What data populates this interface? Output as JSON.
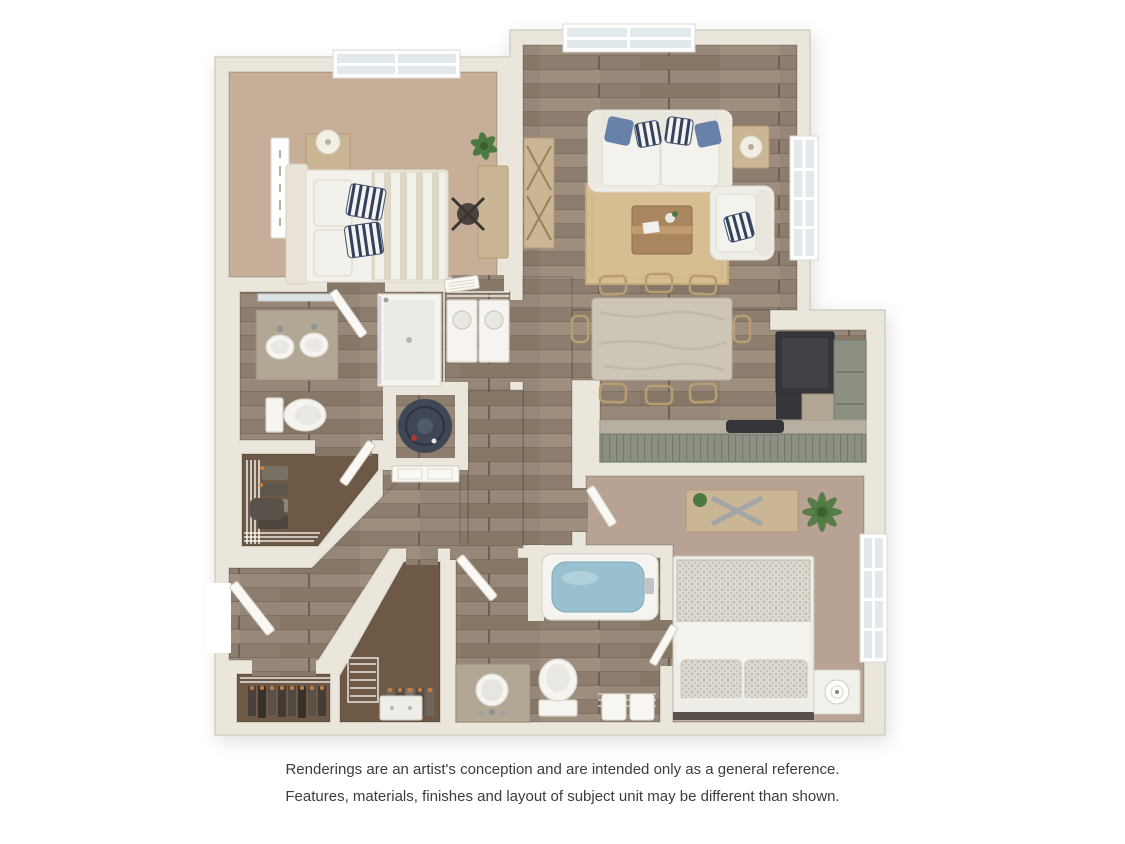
{
  "page": {
    "background": "#ffffff"
  },
  "floorplan": {
    "type": "3d-rendered-apartment-floor-plan",
    "rooms": [
      "bedroom-1",
      "living-room",
      "dining-area",
      "kitchen",
      "bedroom-2",
      "bathroom-1",
      "bathroom-2",
      "laundry-closet",
      "water-heater-closet",
      "walk-in-closet",
      "coat-closet",
      "secondary-closet",
      "entry",
      "hallway"
    ],
    "furniture": [
      "bed",
      "nightstand",
      "table-lamp",
      "wall-art",
      "desk",
      "desk-chair",
      "potted-plant",
      "sofa",
      "accent-pillows",
      "armchair",
      "side-table",
      "coffee-table",
      "area-rug",
      "dining-table",
      "dining-chairs",
      "refrigerator",
      "range",
      "bar-counter",
      "kitchen-cabinets",
      "double-vanity",
      "shower",
      "toilet",
      "washer",
      "dryer",
      "water-heater",
      "bathtub",
      "single-vanity",
      "linen-shelf",
      "towels",
      "dresser",
      "palm-plant",
      "wire-shelving",
      "hanging-clothes"
    ]
  },
  "disclaimer": {
    "line1": "Renderings are an artist's conception and are intended only as a general reference.",
    "line2": "Features, materials, finishes and layout of subject unit may be different than shown."
  },
  "palette": {
    "page_bg": "#ffffff",
    "wall": "#eae6dc",
    "wall_edge": "#d5cfc0",
    "wood_a": "#8c7d6f",
    "wood_b": "#968779",
    "wood_seam": "#6e6153",
    "carpet_bedroom1": "#c6ae99",
    "carpet_bedroom2": "#b7a293",
    "carpet_closet": "#6d5946",
    "rug": "#d7bd92",
    "marble": "#cdc5b6",
    "counter": "#b2a695",
    "cabinet_green": "#8b9083",
    "appliance_dark": "#35353a",
    "fabric_white": "#f3f1eb",
    "accent_blue": "#6881a8",
    "navy": "#31415e",
    "water": "#98c0cf",
    "plant": "#4c7a3e",
    "water_heater": "#3f4756",
    "door": "#f9f8f4",
    "window_pane": "#e2e9ec",
    "wood_furniture": "#cab695",
    "text": "#3c3c3c"
  }
}
